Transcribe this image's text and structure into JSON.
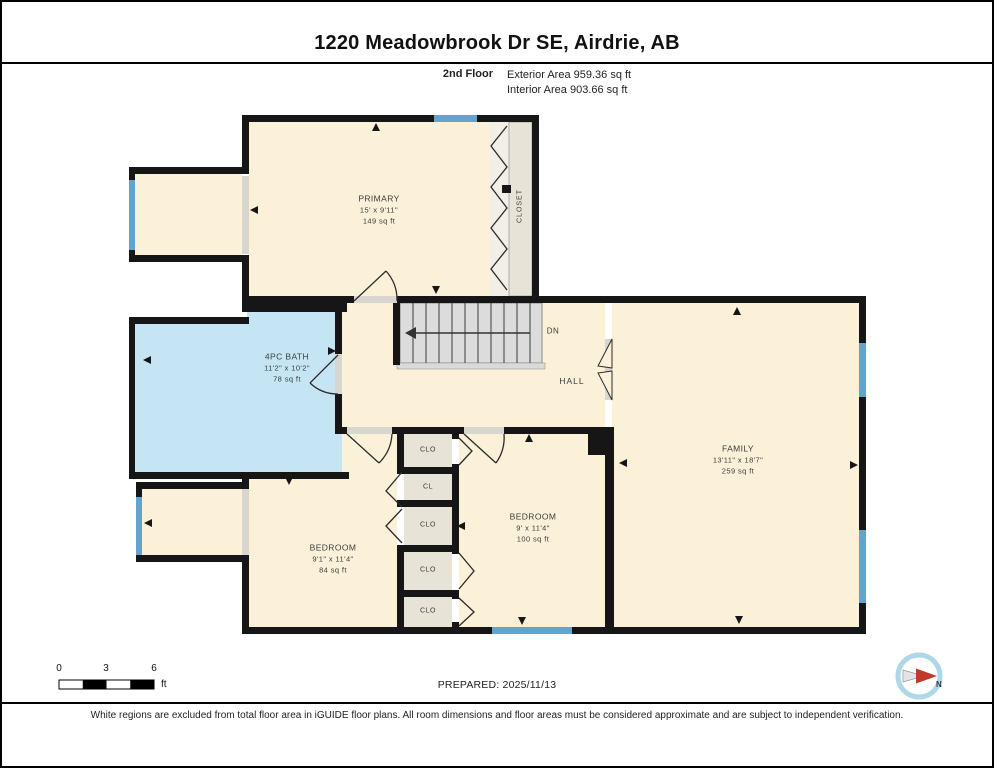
{
  "header": {
    "title": "1220 Meadowbrook Dr SE, Airdrie, AB",
    "floor_label": "2nd Floor",
    "exterior_area": "Exterior Area 959.36 sq ft",
    "interior_area": "Interior Area 903.66 sq ft"
  },
  "rooms": {
    "primary": {
      "name": "PRIMARY",
      "dims": "15' x 9'11\"",
      "area": "149 sq ft"
    },
    "bath": {
      "name": "4PC BATH",
      "dims": "11'2\" x 10'2\"",
      "area": "78 sq ft"
    },
    "family": {
      "name": "FAMILY",
      "dims": "13'11\" x 18'7\"",
      "area": "259 sq ft"
    },
    "bedroom1": {
      "name": "BEDROOM",
      "dims": "9'1\" x 11'4\"",
      "area": "84 sq ft"
    },
    "bedroom2": {
      "name": "BEDROOM",
      "dims": "9' x 11'4\"",
      "area": "100 sq ft"
    },
    "hall": {
      "name": "HALL"
    },
    "closet": {
      "name": "CLOSET"
    },
    "stairs_label": "DN"
  },
  "closets": [
    "CLO",
    "CL",
    "CLO",
    "CLO",
    "CLO"
  ],
  "footer": {
    "scale": {
      "t0": "0",
      "t3": "3",
      "t6": "6",
      "unit": "ft"
    },
    "prepared": "PREPARED: 2025/11/13",
    "compass_north": "N",
    "disclaimer": "White regions are excluded from total floor area in iGUIDE floor plans. All room dimensions and floor areas must be considered approximate and are subject to independent verification."
  },
  "colors": {
    "room_fill": "#FAF1D8",
    "bath_fill": "#C5E5F4",
    "closet_fill": "#E8E3D7",
    "window": "#5FA5CF",
    "stairs_fill": "#DCDCDC",
    "wall": "#161616",
    "compass_ring": "#AFD7EA",
    "compass_needle": "#C03A2B"
  }
}
